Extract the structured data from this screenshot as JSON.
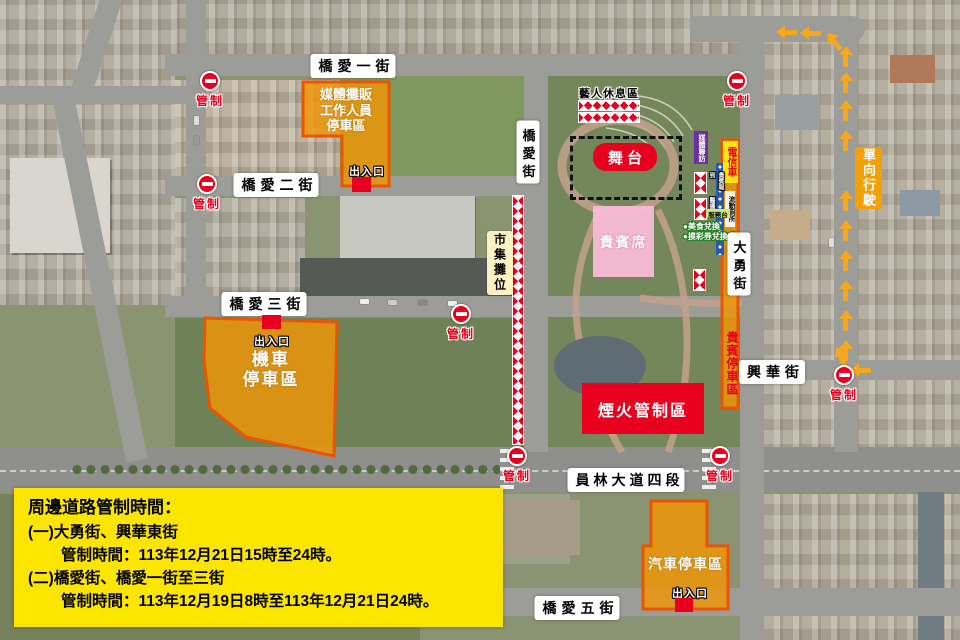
{
  "notice": {
    "title": "周邊道路管制時間：",
    "item1_road": "(一)大勇街、興華東街",
    "item1_time": "管制時間：113年12月21日15時至24時。",
    "item2_road": "(二)橋愛街、橋愛一街至三街",
    "item2_time": "管制時間：113年12月19日8時至113年12月21日24時。"
  },
  "streets": {
    "qiaoai_1": "橋愛一街",
    "qiaoai_2": "橋愛二街",
    "qiaoai_3": "橋愛三街",
    "qiaoai_5": "橋愛五街",
    "qiaoai": "橋愛街",
    "dayong": "大勇街",
    "xinghua": "興華街",
    "yuanlin_blvd_4": "員林大道四段"
  },
  "zones": {
    "media_vendor_parking": "媒體攤販\n工作人員\n停車區",
    "motorcycle_parking": "機車\n停車區",
    "car_parking": "汽車停車區",
    "vip_parking": "貴賓停車區",
    "vip_seating": "貴賓席",
    "stage": "舞台",
    "fireworks_control": "煙火管制區",
    "artist_rest_area": "藝人休息區",
    "market_stalls": "市集攤位",
    "media_interview": "媒體聯訪",
    "telecom_vehicle": "電信車",
    "portable_toilets": "流動廁所",
    "vip_checkin": "貴賓報到",
    "medical_station": "醫護站",
    "service_desk": "服務台",
    "one_way": "單向行駛"
  },
  "markers": {
    "control": "管制",
    "entrance": "出入口"
  },
  "notes": {
    "food": "●美食兌換",
    "raffle": "●摸彩券兌換處"
  },
  "colors": {
    "sign_red": "#e8001e",
    "zone_orange": "#f09605",
    "zone_border_orange": "#ea5504",
    "notice_yellow": "#fce500",
    "arrow_orange": "#f6a71b",
    "vip_pink": "#f8bcd6",
    "media_purple": "#6b2fa3",
    "telecom_yellow": "#ffe60a"
  }
}
